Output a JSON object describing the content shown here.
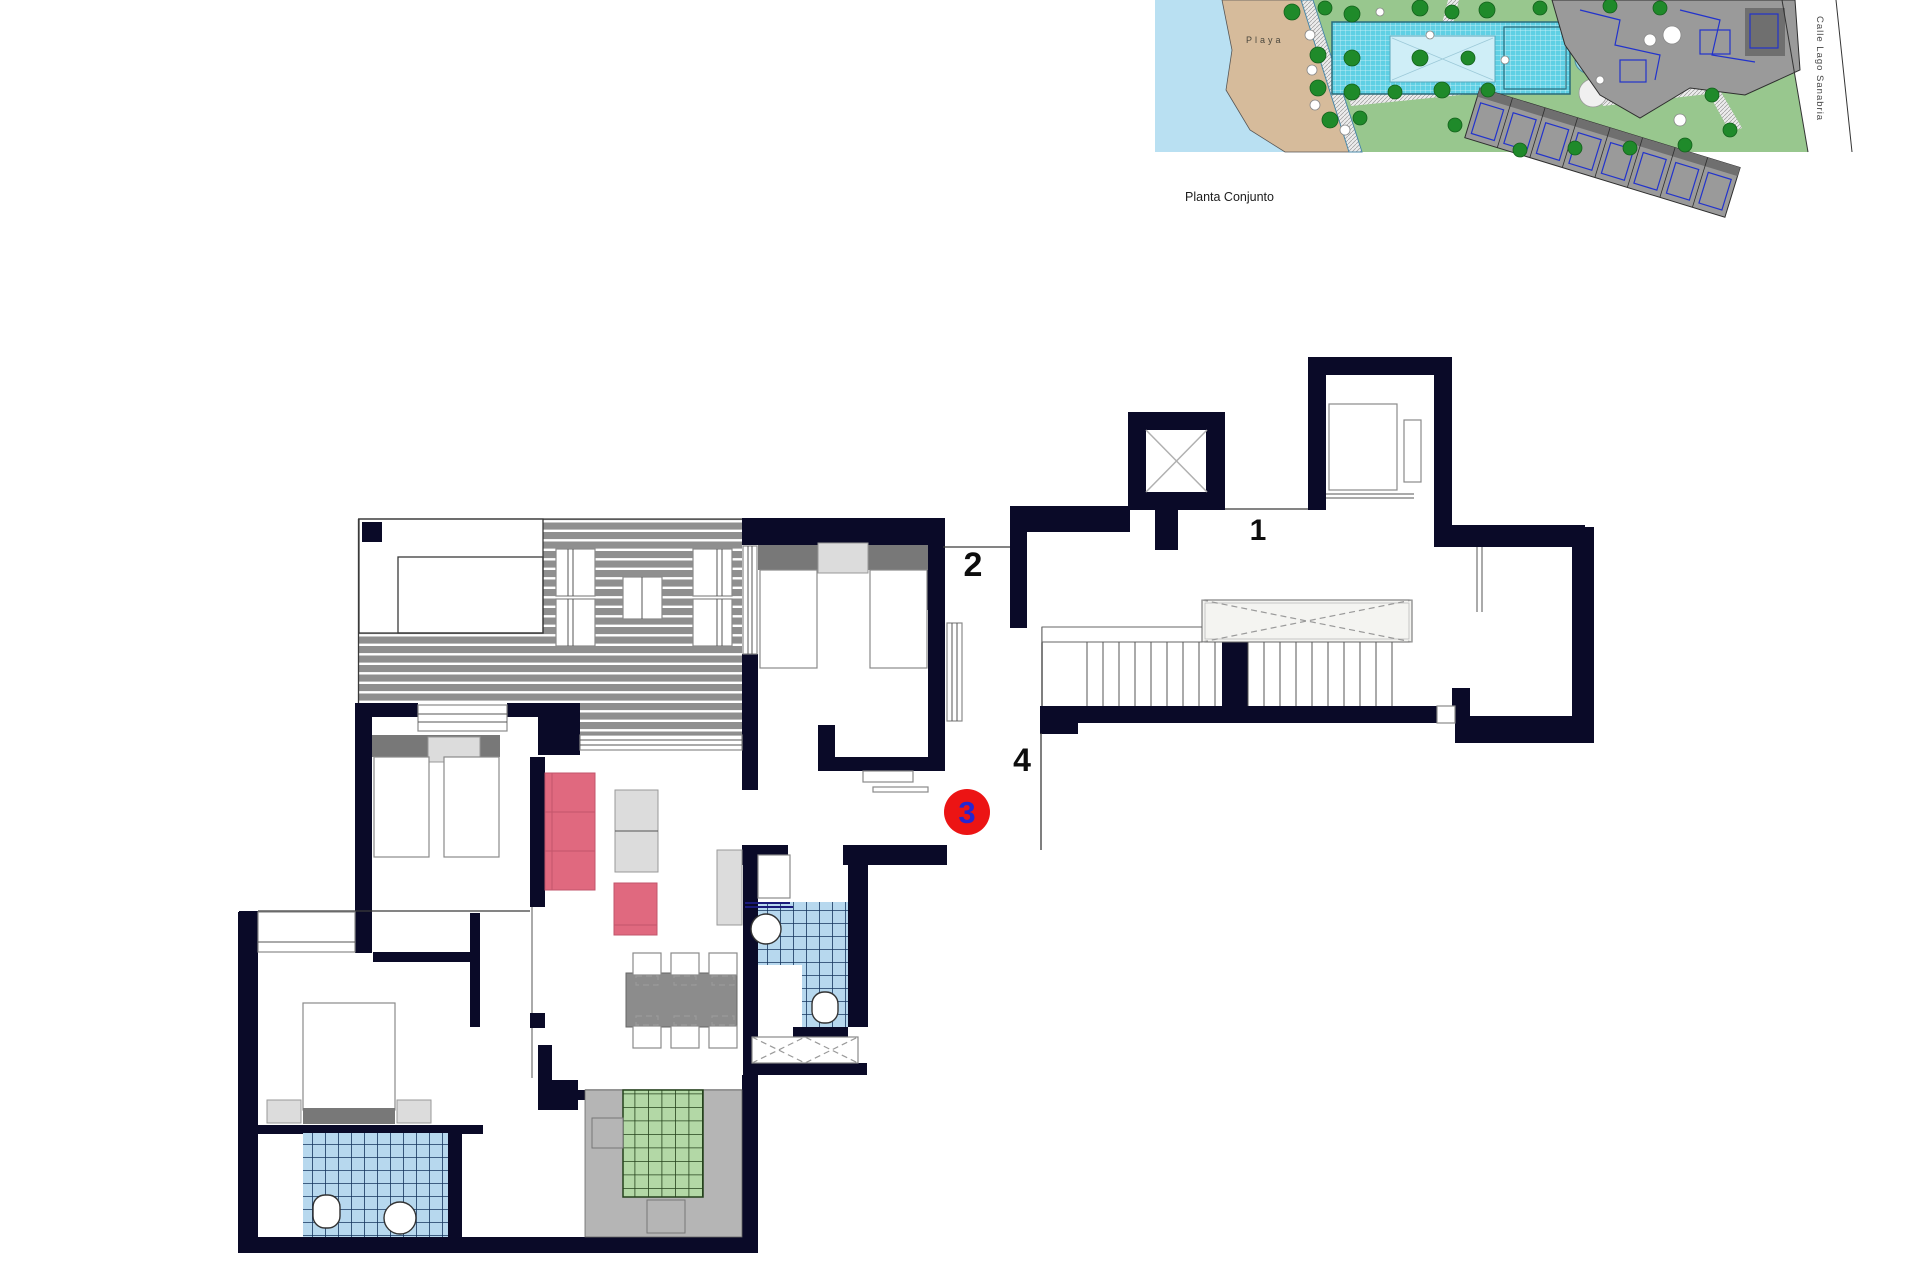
{
  "site_plan": {
    "caption": "Planta Conjunto",
    "beach_label": "Playa",
    "street_label": "Calle Lago Sanabria"
  },
  "floor_plan": {
    "units": {
      "u1": "1",
      "u2": "2",
      "u4": "4"
    },
    "highlighted_unit": {
      "number": "3",
      "badge_color": "#ec1414",
      "number_color": "#2626d0"
    }
  },
  "colors": {
    "wall": "#0a0a28",
    "deck_gray": "#8f8f8f",
    "tile_blue": "#b7d8ee",
    "tile_green": "#b3d8a6",
    "sofa_pink": "#e0697f",
    "headboard_gray": "#787878",
    "water": "#b9e0f2",
    "sand": "#d6bb9b",
    "grass": "#98c78e",
    "pool": "#5fd0e4",
    "building_gray": "#9a9a9a",
    "blueprint_blue": "#2233cc",
    "playground_pink": "#f2bccb"
  }
}
